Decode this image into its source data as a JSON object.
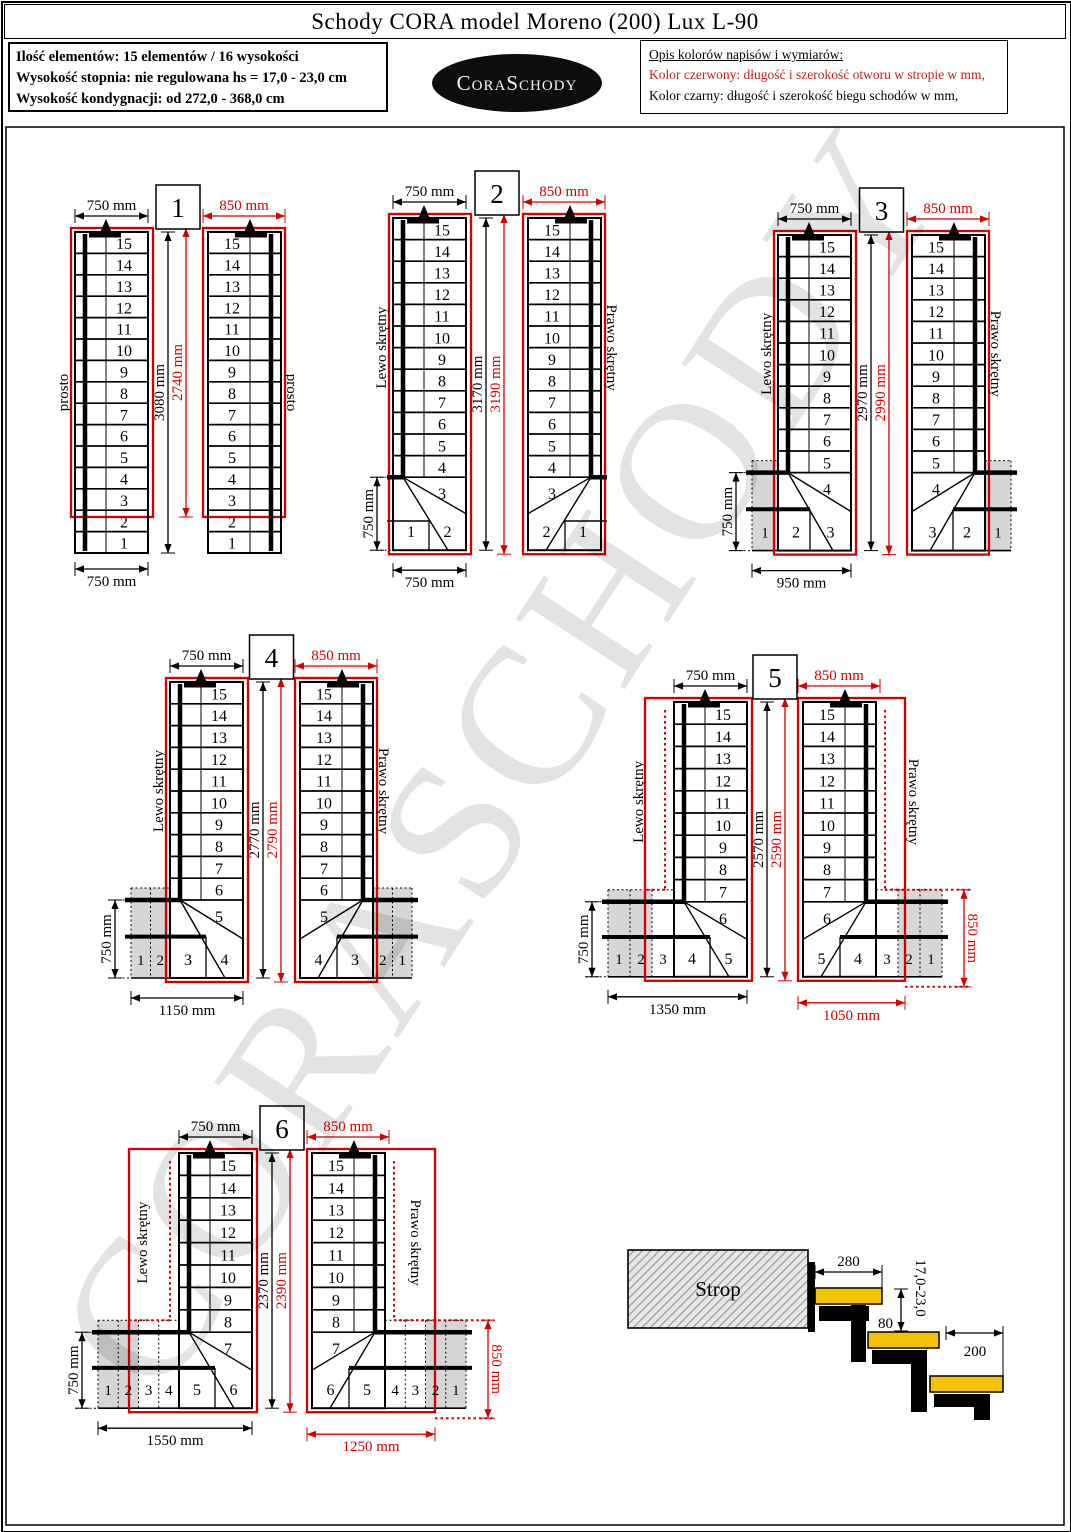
{
  "title": "Schody CORA model Moreno (200) Lux L-90",
  "info_box": {
    "line1": "Ilość elementów: 15 elementów / 16 wysokości",
    "line2": "Wysokość stopnia: nie regulowana  hs = 17,0 - 23,0 cm",
    "line3": "Wysokość kondygnacji: od 272,0 - 368,0 cm"
  },
  "logo_text": "CoraSchody",
  "legend": {
    "title": "Opis kolorów napisów i wymiarów:",
    "red_line": "Kolor czerwony: długość i szerokość otworu w stropie w mm,",
    "black_line": "Kolor czarny: długość i szerokość biegu schodów w mm,"
  },
  "watermark": "CORASCHODY",
  "colors": {
    "red": "#d40000",
    "black": "#000000",
    "gray_fill": "#d6d6d6",
    "tread_yellow": "#f3c200"
  },
  "diagrams": [
    {
      "number": "1",
      "left_label": "prosto",
      "right_label": "prosto",
      "top_dim_left": "750 mm",
      "top_dim_right": "850 mm",
      "bottom_dim_left": "750 mm",
      "height_black": "3080 mm",
      "height_red": "2740 mm",
      "steps_straight": [
        "15",
        "14",
        "13",
        "12",
        "11",
        "10",
        "9",
        "8",
        "7",
        "6",
        "5",
        "4",
        "3",
        "2",
        "1"
      ],
      "ext_cells": []
    },
    {
      "number": "2",
      "left_label": "Lewo skrętny",
      "right_label": "Prawo skrętny",
      "top_dim_left": "750 mm",
      "top_dim_right": "850 mm",
      "bottom_dim_left": "750 mm",
      "winder_height_dim": "750 mm",
      "height_black": "3170 mm",
      "height_red": "3190 mm",
      "steps_straight": [
        "15",
        "14",
        "13",
        "12",
        "11",
        "10",
        "9",
        "8",
        "7",
        "6",
        "5",
        "4"
      ],
      "winder_upper": "3",
      "winder_inner": [
        "1",
        "2"
      ],
      "ext_cells": []
    },
    {
      "number": "3",
      "left_label": "Lewo skrętny",
      "right_label": "Prawo skrętny",
      "top_dim_left": "750 mm",
      "top_dim_right": "850 mm",
      "bottom_dim_left": "950 mm",
      "winder_height_dim": "750 mm",
      "height_black": "2970 mm",
      "height_red": "2990 mm",
      "steps_straight": [
        "15",
        "14",
        "13",
        "12",
        "11",
        "10",
        "9",
        "8",
        "7",
        "6",
        "5"
      ],
      "winder_upper": "4",
      "winder_inner": [
        "2",
        "3"
      ],
      "ext_cells": [
        {
          "label": "1",
          "gray": true
        }
      ]
    },
    {
      "number": "4",
      "left_label": "Lewo skrętny",
      "right_label": "Prawo skrętny",
      "top_dim_left": "750 mm",
      "top_dim_right": "850 mm",
      "bottom_dim_left": "1150 mm",
      "winder_height_dim": "750 mm",
      "height_black": "2770 mm",
      "height_red": "2790 mm",
      "steps_straight": [
        "15",
        "14",
        "13",
        "12",
        "11",
        "10",
        "9",
        "8",
        "7",
        "6"
      ],
      "winder_upper": "5",
      "winder_inner": [
        "3",
        "4"
      ],
      "ext_cells": [
        {
          "label": "1",
          "gray": true
        },
        {
          "label": "2",
          "gray": true
        }
      ]
    },
    {
      "number": "5",
      "left_label": "Lewo skrętny",
      "right_label": "Prawo skrętny",
      "top_dim_left": "750 mm",
      "top_dim_right": "850 mm",
      "bottom_dim_left": "1350 mm",
      "bottom_dim_right": "1050 mm",
      "winder_height_dim": "750 mm",
      "side_dim_right": "850 mm",
      "height_black": "2570 mm",
      "height_red": "2590 mm",
      "steps_straight": [
        "15",
        "14",
        "13",
        "12",
        "11",
        "10",
        "9",
        "8",
        "7"
      ],
      "winder_upper": "6",
      "winder_inner": [
        "4",
        "5"
      ],
      "ext_cells": [
        {
          "label": "1",
          "gray": true
        },
        {
          "label": "2",
          "gray": true
        },
        {
          "label": "3",
          "gray": false
        }
      ]
    },
    {
      "number": "6",
      "left_label": "Lewo skrętny",
      "right_label": "Prawo skrętny",
      "top_dim_left": "750 mm",
      "top_dim_right": "850 mm",
      "bottom_dim_left": "1550 mm",
      "bottom_dim_right": "1250 mm",
      "winder_height_dim": "750 mm",
      "side_dim_right": "850 mm",
      "height_black": "2370 mm",
      "height_red": "2390 mm",
      "steps_straight": [
        "15",
        "14",
        "13",
        "12",
        "11",
        "10",
        "9",
        "8"
      ],
      "winder_upper": "7",
      "winder_inner": [
        "5",
        "6"
      ],
      "ext_cells": [
        {
          "label": "1",
          "gray": true
        },
        {
          "label": "2",
          "gray": true
        },
        {
          "label": "3",
          "gray": false
        },
        {
          "label": "4",
          "gray": false
        }
      ]
    }
  ],
  "section": {
    "strop_label": "Strop",
    "dim_tread_top": "280",
    "dim_gap": "80",
    "dim_height_range": "17,0-23,0",
    "dim_tread": "200"
  }
}
